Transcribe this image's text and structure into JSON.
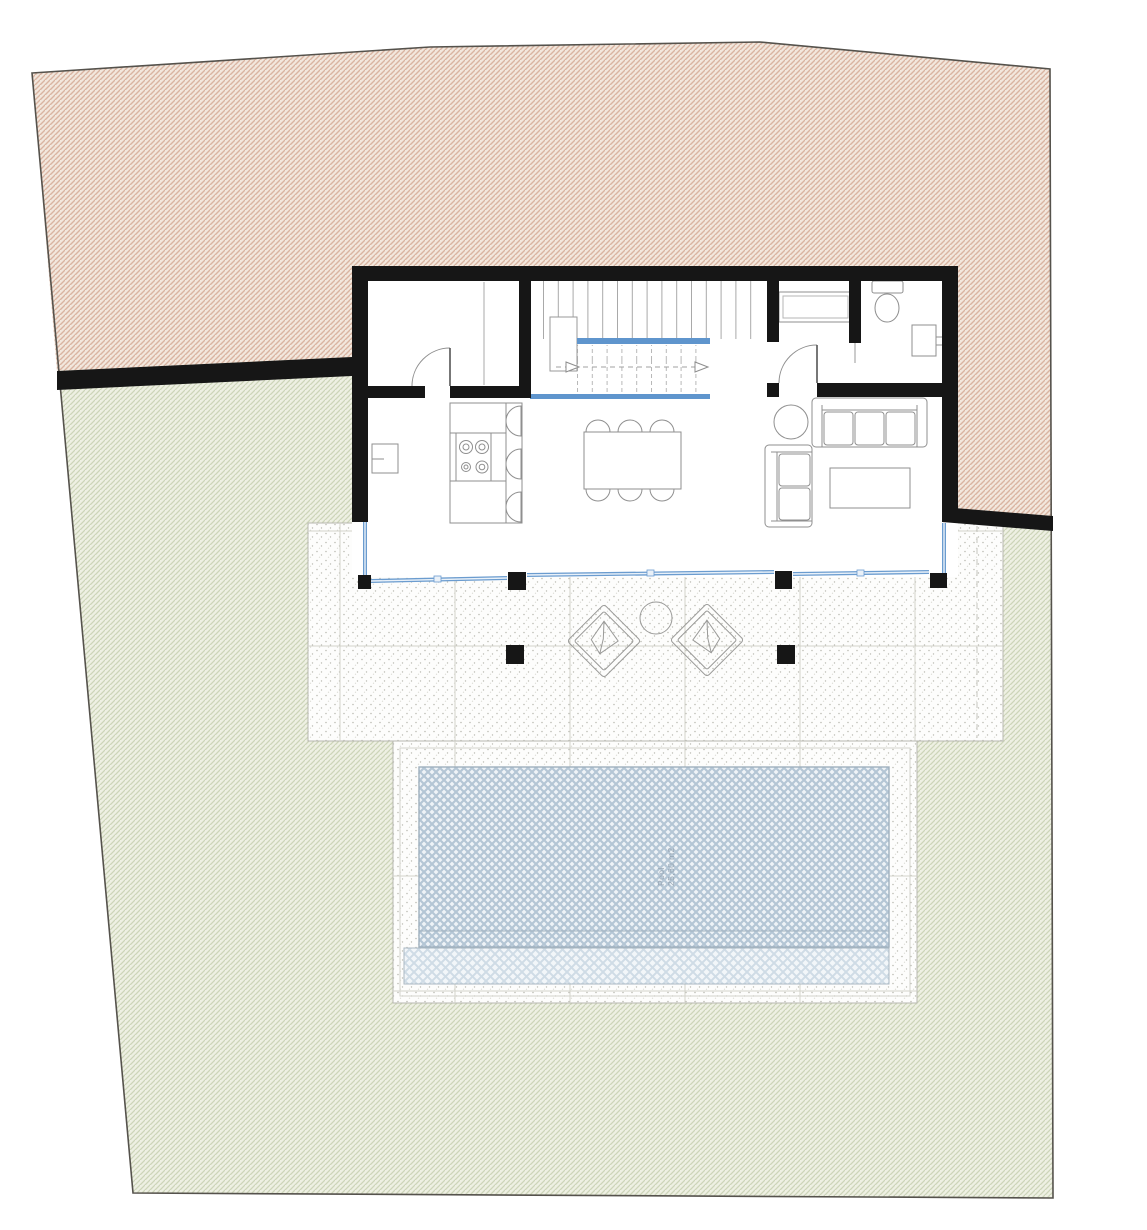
{
  "pool": {
    "label_line1": "Pool",
    "label_line2": "25,60 m2"
  },
  "palette": {
    "boundary": "#55524c",
    "slope_base": "#f2e7dd",
    "slope_line": "#d9b4a1",
    "lawn_base": "#eef0e3",
    "lawn_line": "#cdd5b9",
    "wall": "#161616",
    "glass": "#6b9ccf",
    "glass_core": "#e9f1f9",
    "stair_accent": "#5f95cd",
    "pool_base": "#eef3f7",
    "pool_line": "#b4c6d5",
    "pool_light_base": "#f2f6f9",
    "pool_light_line": "#cfdce6",
    "deck_base": "#fdfdfc",
    "stipple_dot": "#bdbdb5",
    "grid_line": "#d2d2ca",
    "furniture": "#8f8f8f",
    "tread": "#a8a8a8",
    "label_text": "#96a4b2"
  }
}
